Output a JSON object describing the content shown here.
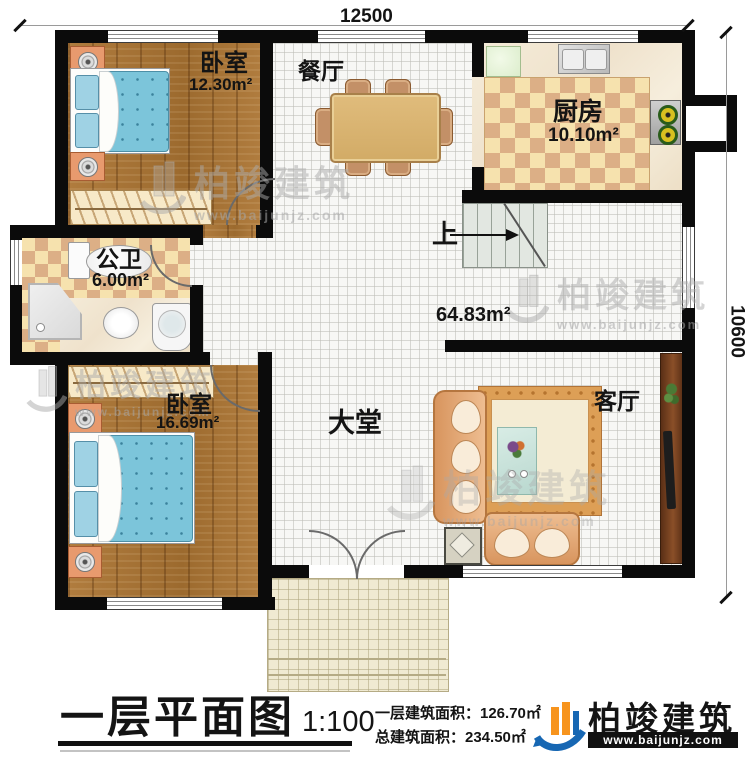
{
  "dims": {
    "top": "12500",
    "right": "10600"
  },
  "rooms": {
    "bedroom1": {
      "name": "卧室",
      "area": "12.30m²"
    },
    "dining": {
      "name": "餐厅"
    },
    "kitchen": {
      "name": "厨房",
      "area": "10.10m²"
    },
    "bathroom": {
      "name": "公卫",
      "area": "6.00m²"
    },
    "bedroom2": {
      "name": "卧室",
      "area": "16.69m²"
    },
    "hall": {
      "name": "大堂",
      "area": "64.83m²"
    },
    "living": {
      "name": "客厅"
    },
    "stairs_up": "上"
  },
  "title_block": {
    "title": "一层平面图",
    "scale": "1:100",
    "line1": "一层建筑面积：126.70㎡",
    "line2": "总建筑面积：234.50㎡"
  },
  "brand": {
    "name": "柏竣建筑",
    "site": "www.baijunjz.com"
  },
  "colors": {
    "wall": "#0b0b0b",
    "checker_light": "#f6e2ae",
    "checker_dark": "#dcaf86",
    "bed_blue": "#7cc5da",
    "logo_blue": "#1767b3",
    "logo_orange": "#f7941d"
  }
}
